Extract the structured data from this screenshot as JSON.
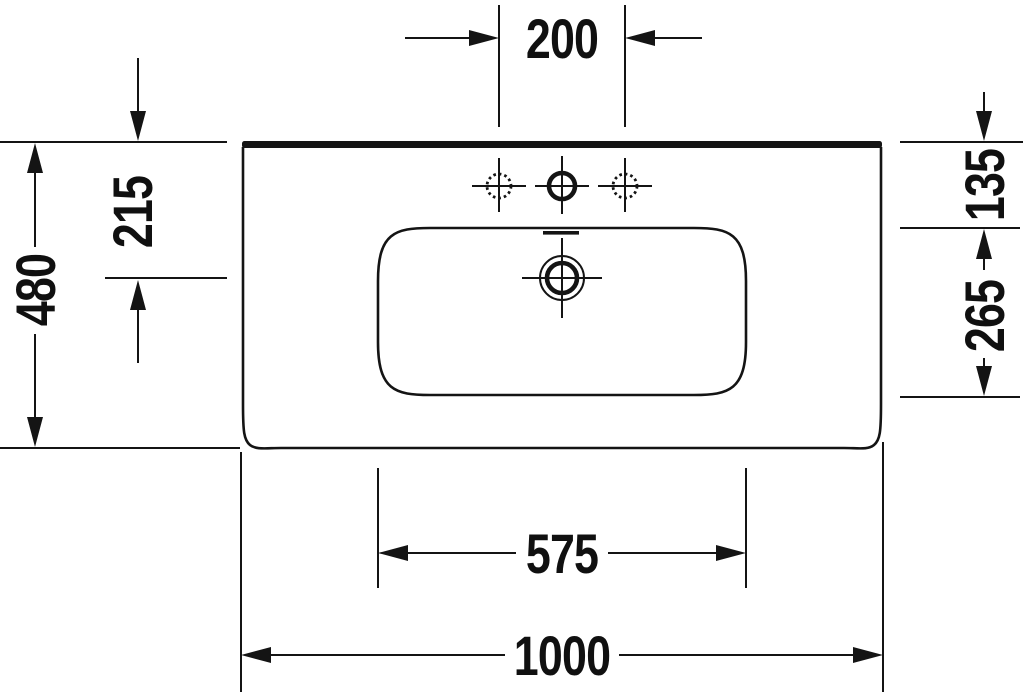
{
  "drawing": {
    "description": "plan-view technical dimension drawing of a rectangular washbasin with three faucet holes, overflow slot and drain",
    "dimensions": {
      "faucet_hole_spacing": "200",
      "overall_depth": "480",
      "back_edge_to_drain": "215",
      "back_edge_to_bowl": "135",
      "bowl_depth": "265",
      "bowl_width": "575",
      "overall_width": "1000"
    },
    "colors": {
      "line": "#141414",
      "background": "#ffffff"
    }
  }
}
